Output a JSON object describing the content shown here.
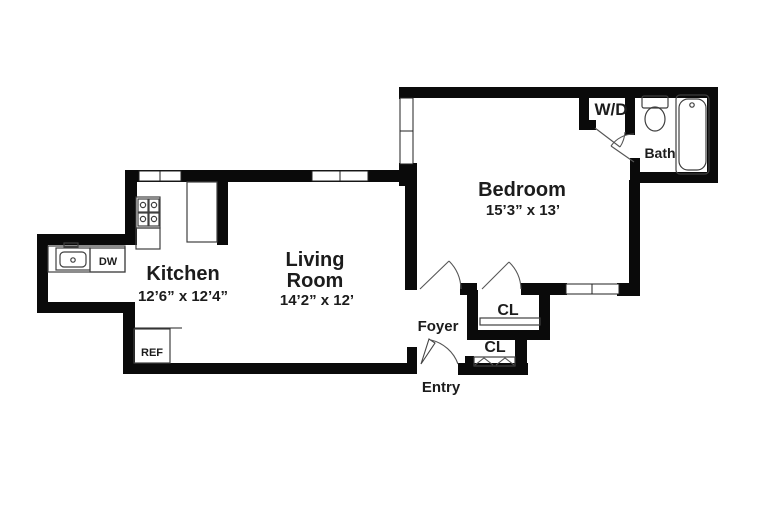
{
  "title": "One-bedroom apartment floor plan",
  "rooms": {
    "kitchen": {
      "name": "Kitchen",
      "dims": "12’6” x 12’4”"
    },
    "living": {
      "line1": "Living",
      "line2": "Room",
      "dims": "14’2” x 12’"
    },
    "bedroom": {
      "name": "Bedroom",
      "dims": "15’3” x 13’"
    },
    "bath": {
      "name": "Bath"
    },
    "laundry_closet": {
      "name": "W/D"
    },
    "foyer": {
      "name": "Foyer"
    },
    "entry": {
      "name": "Entry"
    },
    "closet_upper": {
      "name": "CL"
    },
    "closet_lower": {
      "name": "CL"
    }
  },
  "appliances": {
    "dishwasher": "DW",
    "refrigerator": "REF"
  },
  "colors": {
    "wall": "#0a0a0a",
    "thin_line": "#3f3f3f",
    "text": "#1c1c1c",
    "background": "#ffffff"
  }
}
